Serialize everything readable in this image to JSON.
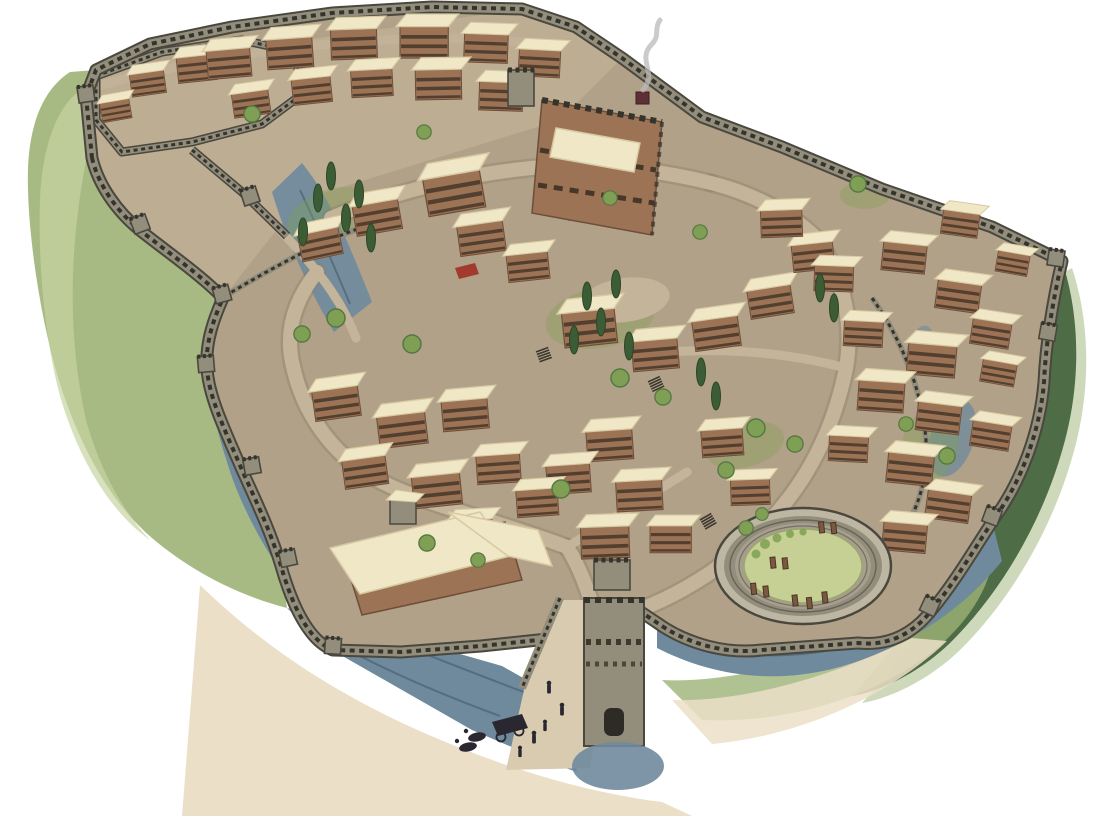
{
  "meta": {
    "title": "Bird's-eye watercolor reconstruction of an ancient fortified hilltop citadel",
    "alt": "Aerial reconstruction illustration of a walled ancient citadel: crenellated stone ramparts ring a hill covered with flat-roofed houses, a central palace with smoke rising, winding cobbled streets, cypress and olive trees, a circular stone precinct with standing stelae, rocky blue-grey cliffs and green slopes outside the walls, and a fortified south gate with tiny figures and a chariot on the approach ramp."
  },
  "scene": {
    "features": [
      "outer-rampart",
      "upper-citadel-fort",
      "palace-with-smoke",
      "watch-towers",
      "lower-town-houses",
      "winding-streets",
      "grave-circle-precinct",
      "standing-stelae",
      "south-gate-tower",
      "approach-ramp",
      "travellers-with-chariot",
      "rock-cliffs",
      "grass-slopes",
      "cypress-trees",
      "round-trees",
      "red-awning"
    ]
  },
  "colors": {
    "bg": "#ffffff",
    "ground": "#b1a188",
    "groundLight": "#c6b89d",
    "road": "#c3b49a",
    "roadEdge": "#8d7f69",
    "wallStone": "#938d7c",
    "wallLight": "#bdb6a3",
    "wallDark": "#4a483e",
    "merlon": "#35342c",
    "rock": "#6f8a9c",
    "rockDark": "#465e70",
    "rockLight": "#a3b8c4",
    "grass": "#9eb377",
    "grassLight": "#c8d4a2",
    "grassDark": "#6c8a55",
    "scrubDark": "#47663f",
    "lawn": "#c7d094",
    "sand": "#ecdfc8",
    "house": "#9c7355",
    "houseDark": "#6e4e3a",
    "windowBand": "#33291f",
    "roof": "#f0e7c7",
    "roofShade": "#d7c9a2",
    "cypress": "#3c5c36",
    "treeGreen": "#7fa054",
    "treeDark": "#567741",
    "stele": "#7b5940",
    "figure": "#2a2730",
    "smoke": "#b9b9ba",
    "accentRed": "#a23b2e"
  }
}
